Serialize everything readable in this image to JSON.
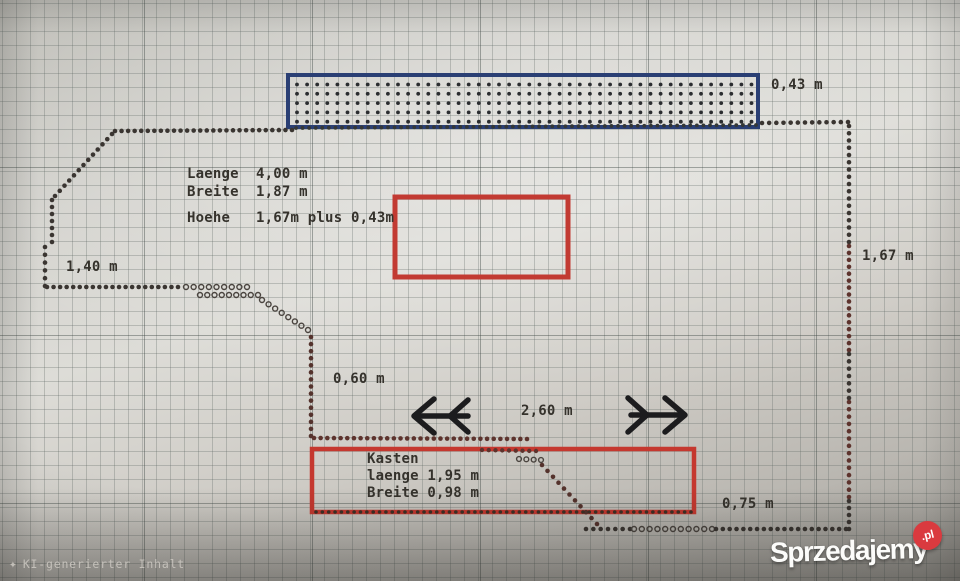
{
  "footer_note": {
    "text": "KI-generierter Inhalt",
    "icon": "sparkle-icon"
  },
  "watermark": {
    "brand": "Sprzedajemy",
    "badge": ".pl",
    "badge_color": "#da3a3f",
    "brand_color": "#fcfcfa"
  },
  "annotations": [
    {
      "id": "laenge-total",
      "text": "Laenge  4,00 m",
      "x": 187,
      "y": 166
    },
    {
      "id": "breite-total",
      "text": "Breite  1,87 m",
      "x": 187,
      "y": 184
    },
    {
      "id": "hoehe-total",
      "text": "Hoehe   1,67m plus 0,43m",
      "x": 187,
      "y": 210
    },
    {
      "id": "dim-0-43",
      "text": "0,43 m",
      "x": 771,
      "y": 77
    },
    {
      "id": "dim-1-40",
      "text": "1,40 m",
      "x": 66,
      "y": 259
    },
    {
      "id": "dim-1-67",
      "text": "1,67 m",
      "x": 862,
      "y": 248
    },
    {
      "id": "dim-0-60",
      "text": "0,60 m",
      "x": 333,
      "y": 371
    },
    {
      "id": "dim-2-60",
      "text": "2,60 m",
      "x": 521,
      "y": 403
    },
    {
      "id": "dim-0-75",
      "text": "0,75 m",
      "x": 722,
      "y": 496
    },
    {
      "id": "kasten-title",
      "text": "Kasten",
      "x": 367,
      "y": 451
    },
    {
      "id": "kasten-laenge",
      "text": "laenge 1,95 m",
      "x": 367,
      "y": 468
    },
    {
      "id": "kasten-breite",
      "text": "Breite 0,98 m",
      "x": 367,
      "y": 485
    }
  ],
  "diagram": {
    "rects": [
      {
        "name": "roof-box-outline",
        "x": 288,
        "y": 75,
        "w": 470,
        "h": 52,
        "stroke": "#2a3f74",
        "stroke_width": 4,
        "dotted_fill": true,
        "fill_dot_color": "#2b2d30"
      },
      {
        "name": "red-box-middle",
        "x": 395,
        "y": 197,
        "w": 173,
        "h": 80,
        "stroke": "#c23a32",
        "stroke_width": 5,
        "dotted_fill": false
      },
      {
        "name": "kasten-box-outline",
        "x": 312,
        "y": 449,
        "w": 382,
        "h": 63,
        "stroke": "#c5382f",
        "stroke_width": 4.5,
        "dotted_fill": false
      }
    ],
    "dot_segments": [
      {
        "name": "outline-top-left",
        "x1": 115,
        "y1": 131,
        "x2": 292,
        "y2": 130,
        "r": 2.3,
        "gap": 6.6,
        "color": "#3a3531"
      },
      {
        "name": "outline-under-roofbox",
        "x1": 296,
        "y1": 128,
        "x2": 756,
        "y2": 125,
        "r": 1.9,
        "gap": 6.6,
        "color": "#343736"
      },
      {
        "name": "outline-top-right",
        "x1": 762,
        "y1": 123,
        "x2": 848,
        "y2": 122,
        "r": 2.3,
        "gap": 6.9,
        "color": "#3a3531"
      },
      {
        "name": "outline-corner-steps",
        "x1": 112,
        "y1": 134,
        "x2": 55,
        "y2": 196,
        "r": 2.3,
        "gap": 6.9,
        "color": "#3a3531"
      },
      {
        "name": "outline-left-upper",
        "x1": 52,
        "y1": 200,
        "x2": 52,
        "y2": 242,
        "r": 2.3,
        "gap": 7.1,
        "color": "#3a3531"
      },
      {
        "name": "outline-left-lower",
        "x1": 45,
        "y1": 247,
        "x2": 45,
        "y2": 286,
        "r": 2.3,
        "gap": 7.1,
        "color": "#3a3531"
      },
      {
        "name": "outline-bottom-left-run",
        "x1": 47,
        "y1": 287,
        "x2": 178,
        "y2": 287,
        "r": 2.3,
        "gap": 6.7,
        "color": "#3a3531"
      },
      {
        "name": "hollow-run-1",
        "x1": 186,
        "y1": 287,
        "x2": 247,
        "y2": 287,
        "r": 2.5,
        "gap": 7.6,
        "color": "#4a443f",
        "open": true
      },
      {
        "name": "hollow-run-2",
        "x1": 200,
        "y1": 295,
        "x2": 258,
        "y2": 295,
        "r": 2.5,
        "gap": 7.6,
        "color": "#4a443f",
        "open": true
      },
      {
        "name": "hollow-staircase",
        "x1": 262,
        "y1": 300,
        "x2": 308,
        "y2": 330,
        "r": 2.5,
        "gap": 7.6,
        "color": "#4a443f",
        "open": true
      },
      {
        "name": "inner-vertical",
        "x1": 311,
        "y1": 337,
        "x2": 311,
        "y2": 436,
        "r": 2.3,
        "gap": 7.1,
        "color": "#54322c"
      },
      {
        "name": "inner-horizontal",
        "x1": 314,
        "y1": 438,
        "x2": 527,
        "y2": 439,
        "r": 2.3,
        "gap": 6.7,
        "color": "#5d332d"
      },
      {
        "name": "kasten-inner-run",
        "x1": 482,
        "y1": 450,
        "x2": 536,
        "y2": 451,
        "r": 2.2,
        "gap": 6.8,
        "color": "#5d332d"
      },
      {
        "name": "kasten-hollow-run",
        "x1": 519,
        "y1": 459,
        "x2": 541,
        "y2": 460,
        "r": 2.4,
        "gap": 7.2,
        "color": "#4a443f",
        "open": true
      },
      {
        "name": "kasten-staircase",
        "x1": 542,
        "y1": 465,
        "x2": 597,
        "y2": 524,
        "r": 2.3,
        "gap": 7.8,
        "color": "#54322c"
      },
      {
        "name": "outline-on-kasten-bottom",
        "x1": 316,
        "y1": 512,
        "x2": 691,
        "y2": 512,
        "r": 1.8,
        "gap": 6.4,
        "color": "#3c3026"
      },
      {
        "name": "outline-bottom-run-1",
        "x1": 586,
        "y1": 529,
        "x2": 630,
        "y2": 529,
        "r": 2.3,
        "gap": 7.0,
        "color": "#3a3531"
      },
      {
        "name": "outline-bottom-hollow",
        "x1": 634,
        "y1": 529,
        "x2": 712,
        "y2": 529,
        "r": 2.5,
        "gap": 7.6,
        "color": "#4a443f",
        "open": true
      },
      {
        "name": "outline-bottom-run-2",
        "x1": 716,
        "y1": 529,
        "x2": 846,
        "y2": 529,
        "r": 2.3,
        "gap": 7.0,
        "color": "#3a3531"
      },
      {
        "name": "outline-right-1",
        "x1": 849,
        "y1": 126,
        "x2": 849,
        "y2": 242,
        "r": 2.3,
        "gap": 7.1,
        "color": "#3a3531"
      },
      {
        "name": "outline-right-2",
        "x1": 849,
        "y1": 246,
        "x2": 849,
        "y2": 350,
        "r": 2.3,
        "gap": 7.1,
        "color": "#5d332d"
      },
      {
        "name": "outline-right-3",
        "x1": 849,
        "y1": 354,
        "x2": 849,
        "y2": 398,
        "r": 2.3,
        "gap": 7.1,
        "color": "#3a3531"
      },
      {
        "name": "outline-right-4",
        "x1": 849,
        "y1": 402,
        "x2": 849,
        "y2": 497,
        "r": 2.3,
        "gap": 7.1,
        "color": "#5d332d"
      },
      {
        "name": "outline-right-5",
        "x1": 849,
        "y1": 501,
        "x2": 849,
        "y2": 529,
        "r": 2.3,
        "gap": 7.1,
        "color": "#3a3531"
      }
    ],
    "arrows": [
      {
        "name": "arrow-left",
        "color": "#1c1c1e",
        "stroke_width": 5.5,
        "polylines": [
          [
            415,
            416,
            468,
            416
          ],
          [
            434,
            399,
            414,
            416,
            434,
            433
          ],
          [
            468,
            400,
            450,
            416,
            468,
            432
          ]
        ]
      },
      {
        "name": "arrow-right",
        "color": "#1c1c1e",
        "stroke_width": 5.5,
        "polylines": [
          [
            631,
            415,
            684,
            415
          ],
          [
            665,
            398,
            685,
            415,
            665,
            432
          ],
          [
            628,
            398,
            647,
            415,
            628,
            432
          ]
        ]
      }
    ],
    "fill_dots": {
      "row_count": 5,
      "row_start": 84.5,
      "row_step": 9.3,
      "col_start": 297,
      "col_step": 10.1,
      "col_end": 752,
      "r": 1.9
    }
  }
}
